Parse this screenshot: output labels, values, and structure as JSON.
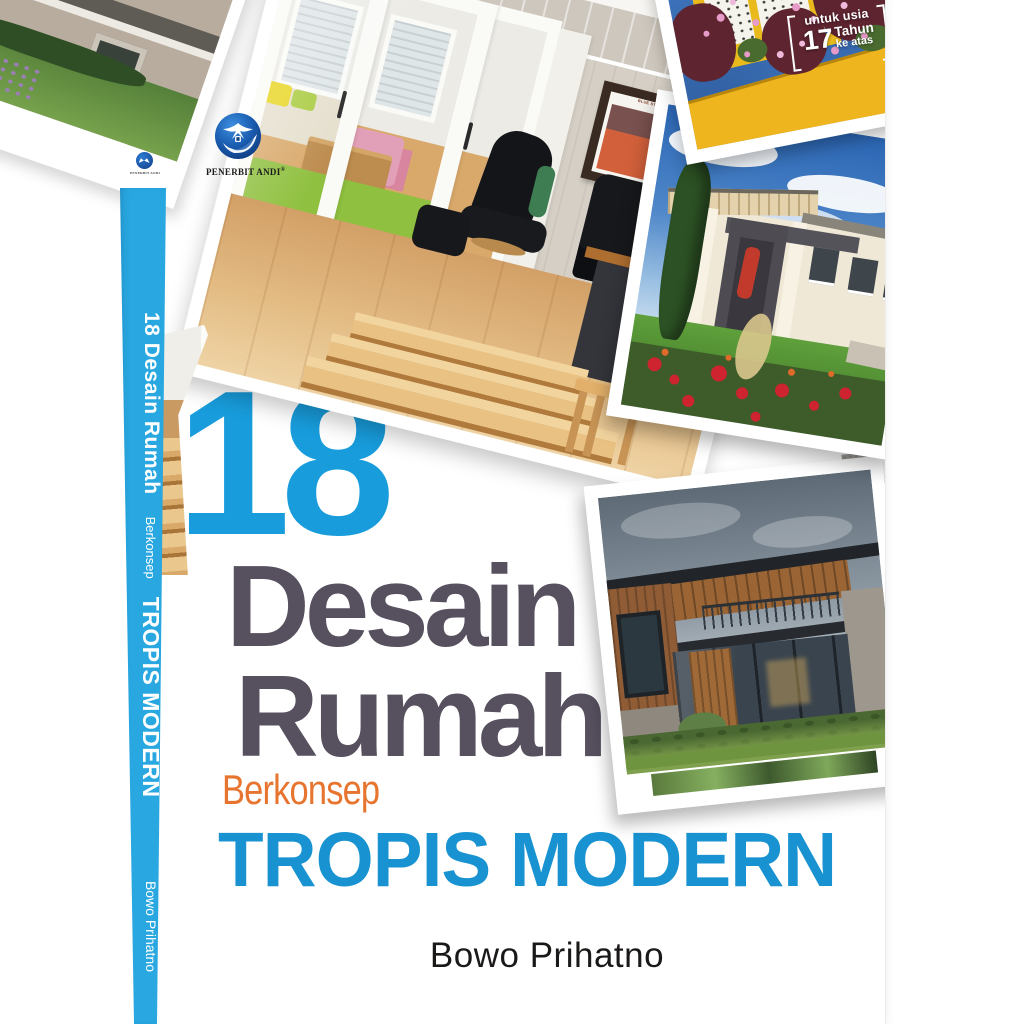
{
  "book": {
    "publisher": {
      "name": "PENERBIT ANDI",
      "registered": "®"
    },
    "age_badge": {
      "line1": "untuk usia",
      "number": "17",
      "unit": "Tahun",
      "line2": "ke atas"
    },
    "spine": {
      "line1": "18 Desain Rumah",
      "line2": "Berkonsep",
      "line3": "TROPIS MODERN",
      "author": "Bowo Prihatno",
      "color": "#29A7E0"
    },
    "title": {
      "number": "18",
      "word1": "Desain",
      "word2": "Rumah",
      "subtitle_prefix": "Berkonsep",
      "subtitle_main": "TROPIS MODERN"
    },
    "author": "Bowo Prihatno",
    "colors": {
      "number_blue": "#189CDB",
      "title_slate": "#57505F",
      "subtitle_orange": "#E7752F",
      "subtitle_blue": "#1892D0",
      "spine_cyan": "#29A7E0"
    },
    "photos": {
      "main_interior": {
        "alt": "Bright living room interior with white sliding doors, black recliner, wooden floor and steps",
        "poster_caption": "BLUE STAR LINE"
      },
      "top_right": {
        "alt": "Yellow-framed window on a blue wall with pink flowers"
      },
      "middle_right": {
        "alt": "Modern tropical house with dark grey entrance, cypress tree and rose garden"
      },
      "bottom_right": {
        "alt": "Modern wooden house with flat roof, glass walls and green lawn"
      },
      "back_cover": {
        "alt": "House corner with window and garden lawn"
      }
    }
  }
}
